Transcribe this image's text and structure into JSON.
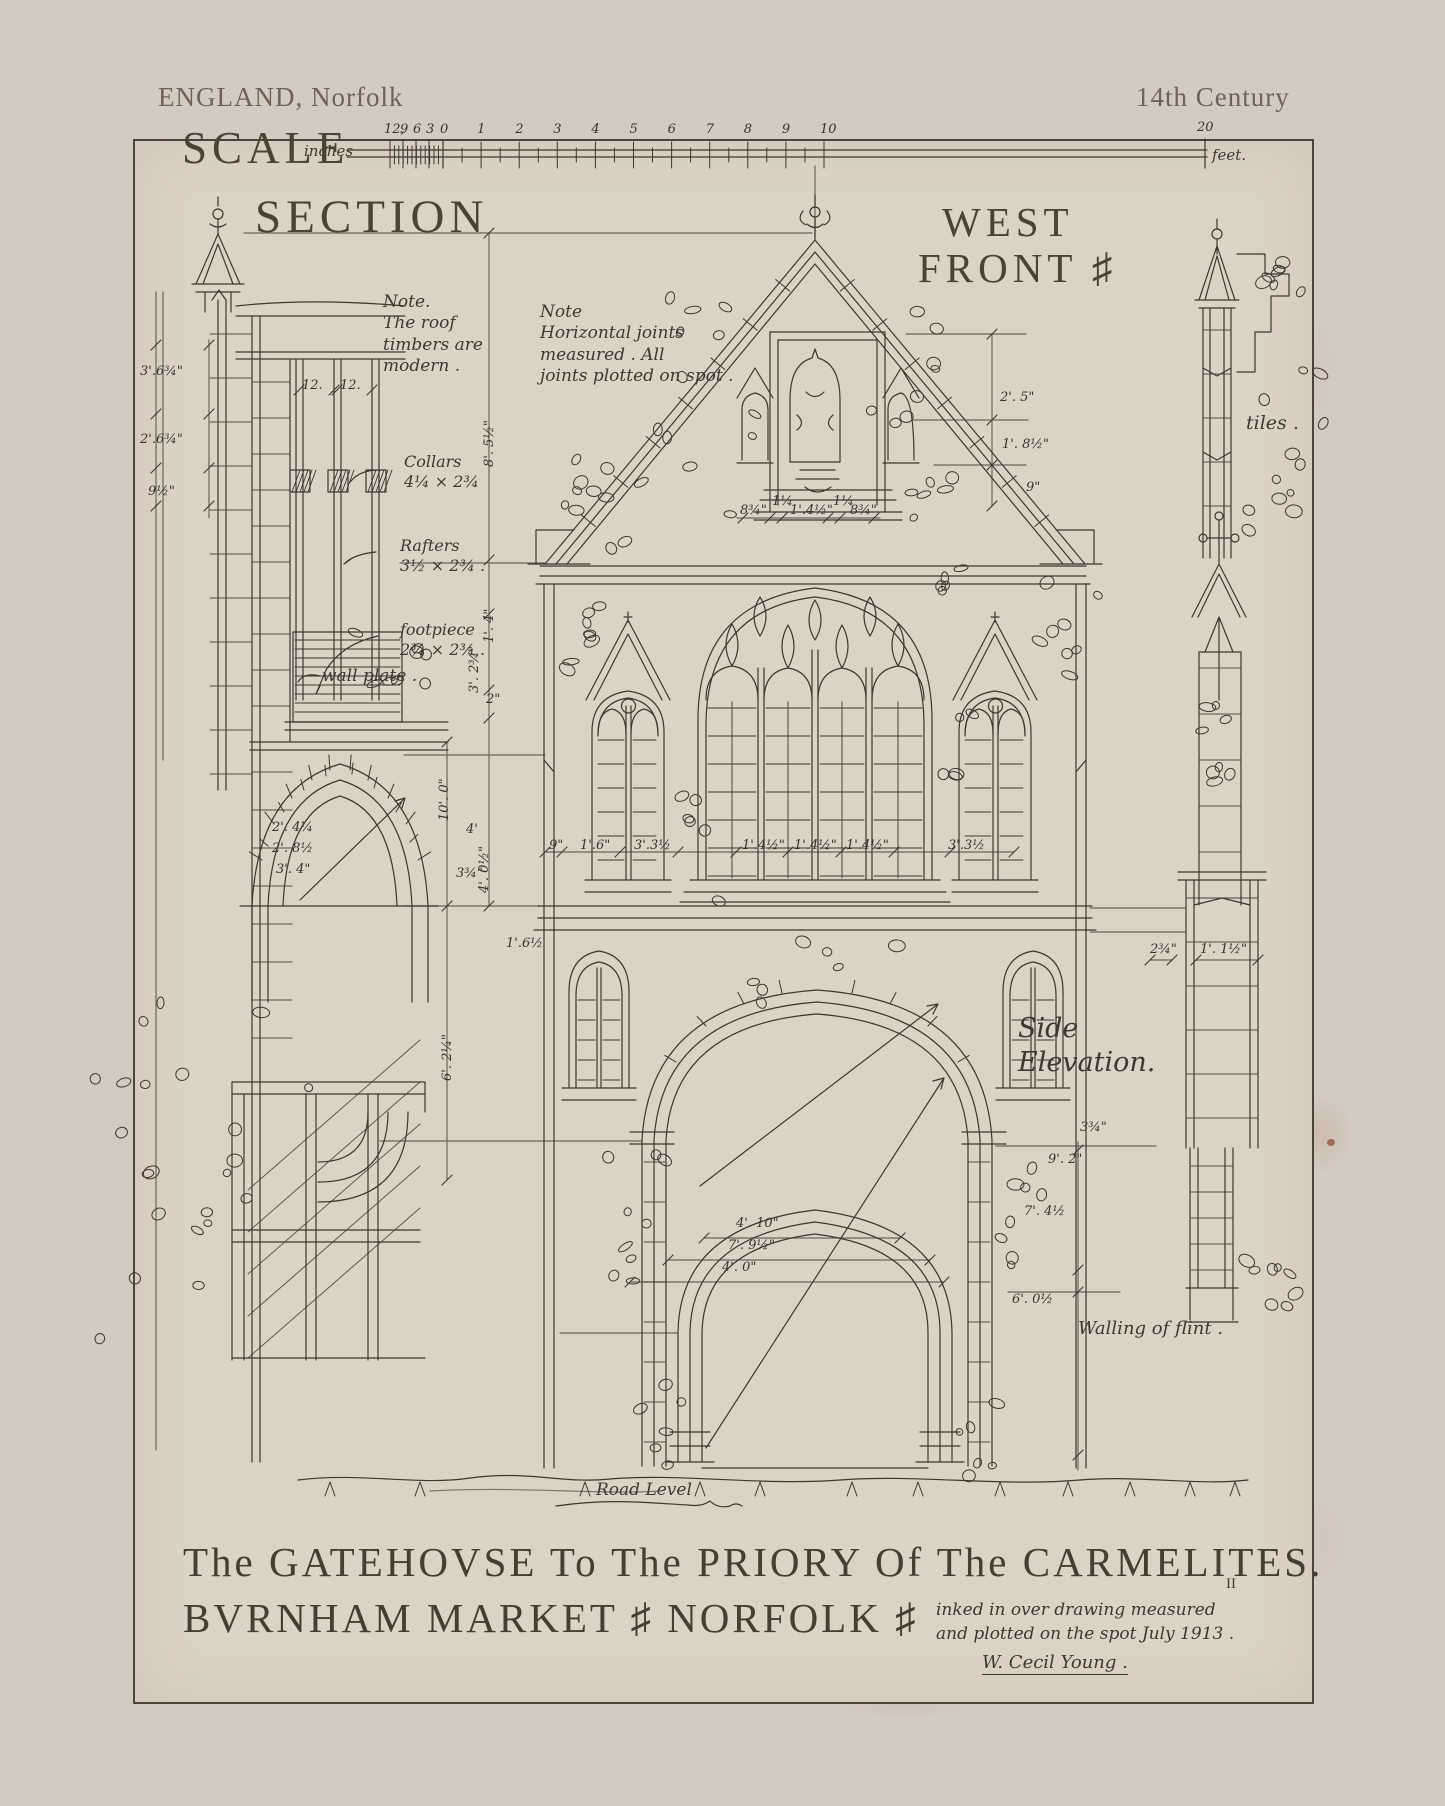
{
  "header": {
    "left": "ENGLAND, Norfolk",
    "right": "14th Century"
  },
  "scale_bar": {
    "title": "SCALE",
    "unit_left": "inches",
    "unit_right": "feet.",
    "inch_labels": [
      "12,",
      "9",
      "6",
      "3",
      "0"
    ],
    "foot_labels": [
      "1",
      "2",
      "3",
      "4",
      "5",
      "6",
      "7",
      "8",
      "9",
      "10"
    ],
    "end_label": "20"
  },
  "titles": {
    "section": "SECTION",
    "west_front_line1": "WEST",
    "west_front_line2": "FRONT ♯",
    "side_elevation": "Side\nElevation.",
    "main_line1": "The GATEHOVSE To The PRIORY Of The CARMELITES.",
    "main_mark": "II",
    "main_line2": "BVRNHAM   MARKET ♯   NORFOLK ♯"
  },
  "notes": {
    "roof": "Note.\nThe roof\ntimbers are\nmodern .",
    "joints": "Note\nHorizontal joints\nmeasured .  All\njoints plotted on spot .",
    "collars": "Collars\n4¼ × 2¾",
    "rafters": "Rafters\n3½ × 2¾ .",
    "footpiece": "footpiece\n2¾ × 2¾ .",
    "wall_plate": "wall plate .",
    "tiles": "tiles .",
    "walling": "Walling of flint .",
    "road_level": "Road Level",
    "credit_line1": "inked in over drawing measured",
    "credit_line2": "and plotted on the spot July 1913 .",
    "signature": "W. Cecil Young ."
  },
  "dimensions": [
    {
      "t": "12.",
      "x": 302,
      "y": 378
    },
    {
      "t": "12.",
      "x": 340,
      "y": 378
    },
    {
      "t": "3'.6¾\"",
      "x": 140,
      "y": 364
    },
    {
      "t": "2'.6¾\"",
      "x": 140,
      "y": 432
    },
    {
      "t": "9½\"",
      "x": 148,
      "y": 484
    },
    {
      "t": "8'. 5½\"",
      "x": 497,
      "y": 452,
      "r": -90
    },
    {
      "t": "1'. 4\"",
      "x": 497,
      "y": 628,
      "r": -90
    },
    {
      "t": "3'. 2¾\"",
      "x": 482,
      "y": 678,
      "r": -90
    },
    {
      "t": "2\"",
      "x": 486,
      "y": 692
    },
    {
      "t": "10'. 0\"",
      "x": 452,
      "y": 806,
      "r": -90
    },
    {
      "t": "4'. 0½\"",
      "x": 492,
      "y": 878,
      "r": -90
    },
    {
      "t": "6'. 2¼\"",
      "x": 455,
      "y": 1066,
      "r": -90
    },
    {
      "t": "4'",
      "x": 466,
      "y": 822
    },
    {
      "t": "3¾\"",
      "x": 456,
      "y": 866
    },
    {
      "t": "2'. 4¼",
      "x": 272,
      "y": 820
    },
    {
      "t": "2'. 8½",
      "x": 272,
      "y": 841
    },
    {
      "t": "3'. 4\"",
      "x": 276,
      "y": 862
    },
    {
      "t": "1'.6½",
      "x": 506,
      "y": 936
    },
    {
      "t": "8¾\"",
      "x": 740,
      "y": 503
    },
    {
      "t": "1¼",
      "x": 772,
      "y": 494
    },
    {
      "t": "1'.4½\"",
      "x": 790,
      "y": 503
    },
    {
      "t": "1¼",
      "x": 833,
      "y": 494
    },
    {
      "t": "8¾\"",
      "x": 850,
      "y": 503
    },
    {
      "t": "2'. 5\"",
      "x": 1000,
      "y": 390
    },
    {
      "t": "1'. 8½\"",
      "x": 1002,
      "y": 437
    },
    {
      "t": "9\"",
      "x": 1026,
      "y": 480
    },
    {
      "t": "9\"",
      "x": 549,
      "y": 838
    },
    {
      "t": "1'.6\"",
      "x": 580,
      "y": 838
    },
    {
      "t": "3'.3½",
      "x": 634,
      "y": 838
    },
    {
      "t": "1'.4½\"",
      "x": 742,
      "y": 838
    },
    {
      "t": "1'.4½\"",
      "x": 794,
      "y": 838
    },
    {
      "t": "1'.4½\"",
      "x": 846,
      "y": 838
    },
    {
      "t": "3'.3½",
      "x": 948,
      "y": 838
    },
    {
      "t": "2¾\"",
      "x": 1150,
      "y": 942
    },
    {
      "t": "1'. 1½\"",
      "x": 1200,
      "y": 942
    },
    {
      "t": "3¾\"",
      "x": 1080,
      "y": 1120
    },
    {
      "t": "9'. 2\"",
      "x": 1048,
      "y": 1152
    },
    {
      "t": "7'. 4½",
      "x": 1024,
      "y": 1204
    },
    {
      "t": "6'. 0½",
      "x": 1012,
      "y": 1292
    },
    {
      "t": "4'. 10\"",
      "x": 736,
      "y": 1216
    },
    {
      "t": "7'. 9½\"",
      "x": 728,
      "y": 1238
    },
    {
      "t": "4'. 0\"",
      "x": 722,
      "y": 1260
    }
  ]
}
